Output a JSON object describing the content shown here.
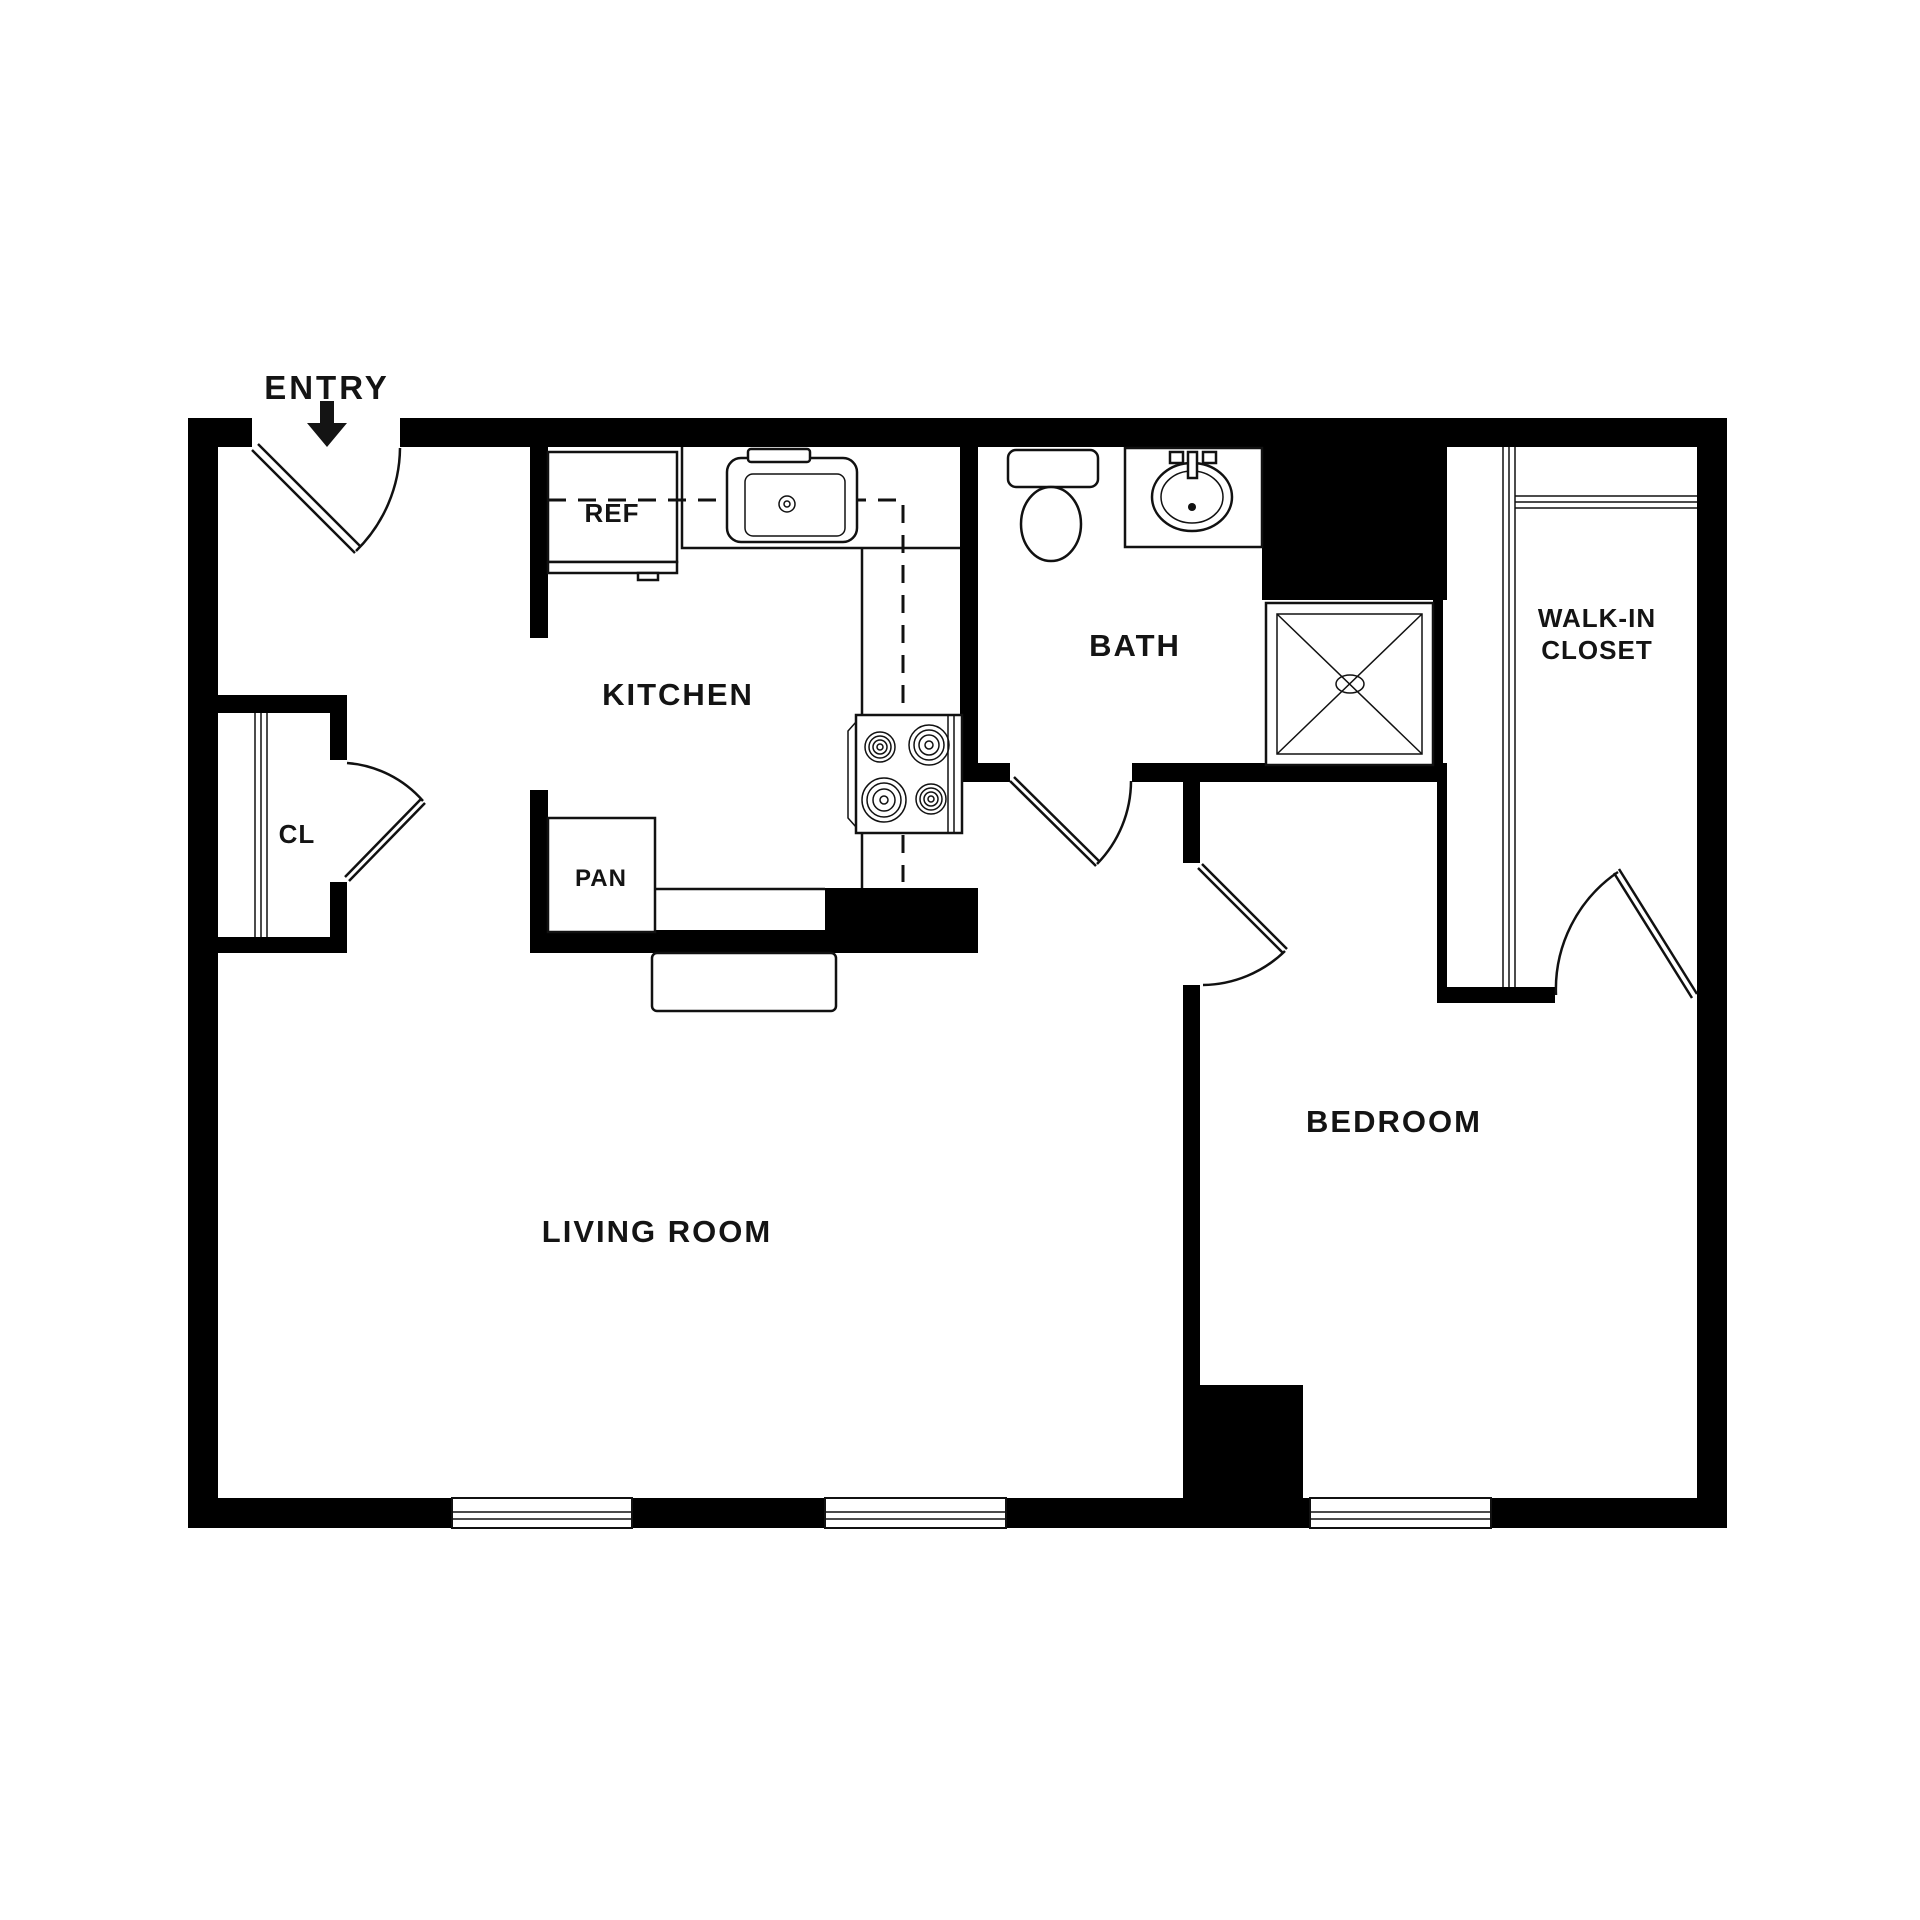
{
  "floor_plan": {
    "colors": {
      "wall": "#000000",
      "background": "#ffffff",
      "text": "#141414",
      "line": "#111111"
    },
    "entry": {
      "label": "ENTRY",
      "arrow_icon": "down-arrow"
    },
    "rooms": {
      "kitchen": {
        "label": "KITCHEN"
      },
      "bath": {
        "label": "BATH"
      },
      "walk_in_closet": {
        "label_line1": "WALK-IN",
        "label_line2": "CLOSET"
      },
      "living_room": {
        "label": "LIVING ROOM"
      },
      "bedroom": {
        "label": "BEDROOM"
      },
      "hall_closet": {
        "label": "CL"
      }
    },
    "fixtures": {
      "refrigerator": {
        "label": "REF"
      },
      "pantry": {
        "label": "PAN"
      }
    }
  }
}
